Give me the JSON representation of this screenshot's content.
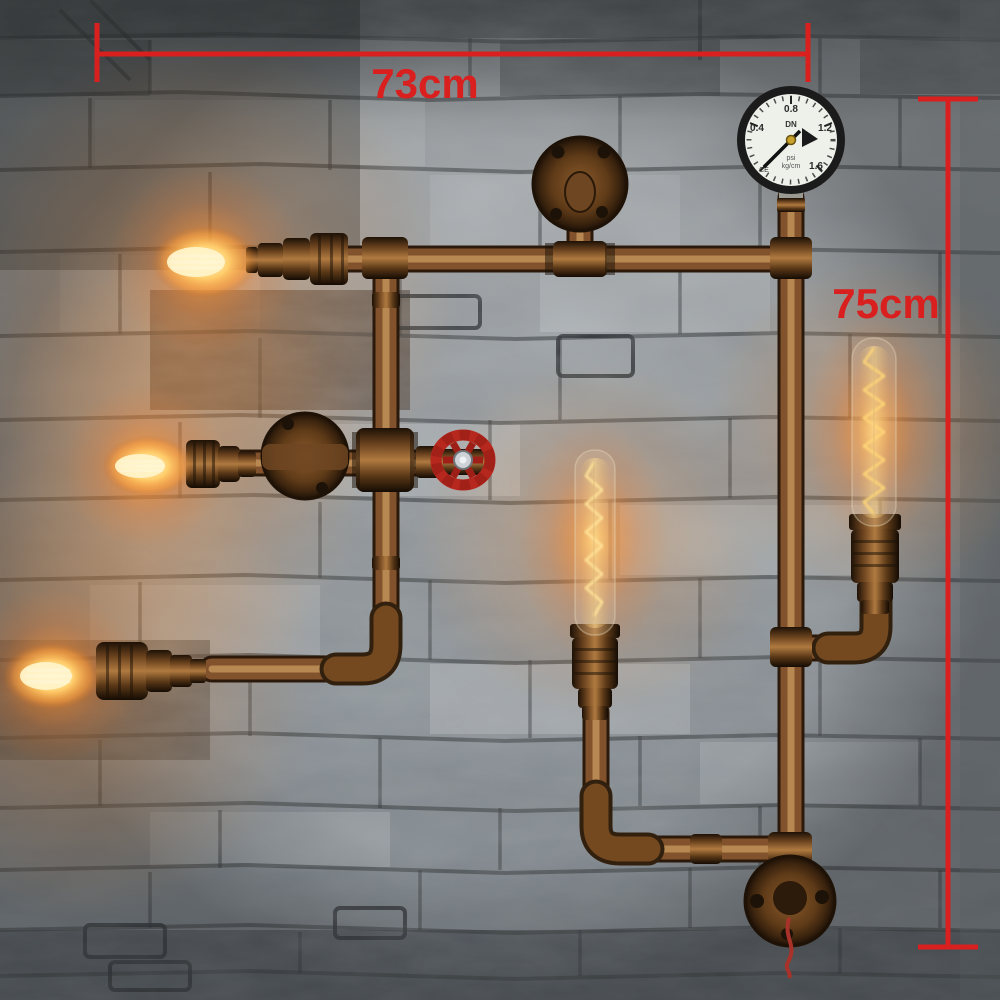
{
  "annotations": {
    "width": {
      "label": "73cm"
    },
    "height": {
      "label": "75cm"
    },
    "color": "#da1f1f"
  },
  "gauge": {
    "tick_labels": [
      "0.4",
      "0.8",
      "1.2",
      "1.6"
    ],
    "center_label": "DN",
    "unit_line1": "psi",
    "unit_line2": "kg/cm",
    "ce_mark": "CE"
  },
  "palette": {
    "annotation_red": "#da1f1f",
    "pipe_copper": "#81522b",
    "pipe_highlight": "#c99b5f",
    "bulb_glow": "#ff9c2e",
    "valve_red": "#b6271e",
    "wall_gray": "#a7adb0",
    "gauge_face": "#eef0ea"
  }
}
